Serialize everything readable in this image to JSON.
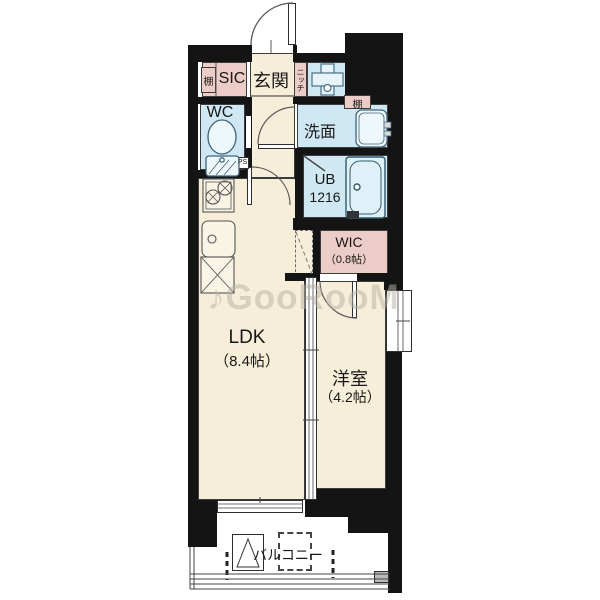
{
  "watermark": "♪GooRooM",
  "labels": {
    "shelf_entrance": "棚",
    "sic": "SIC",
    "genkan": "玄関",
    "niche": "ニッチ",
    "wc": "WC",
    "ps": "PS",
    "washroom": "洗面",
    "shelf_washroom": "棚",
    "unit_bath": "UB",
    "unit_bath_size": "1216",
    "wic": "WIC",
    "wic_area": "（0.8帖）",
    "ldk": "LDK",
    "ldk_area": "（8.4帖）",
    "western_room": "洋室",
    "western_room_area": "（4.2帖）",
    "balcony": "バルコニー"
  },
  "colors": {
    "wall": "#141414",
    "room_beige": "#f6eed8",
    "wet_area_blue": "#cfe8f4",
    "storage_pink": "#ecccc6",
    "fixture_line": "#3f637a",
    "watermark_gray": "#b8b2a6"
  },
  "icons": {
    "entrance-door-icon": "quarter-arc swing door",
    "interior-door-icon": "quarter-arc swing door",
    "folding-bath-door-icon": "diagonal line",
    "toilet-icon": "bowl and tank",
    "washbasin-icon": "rounded basin with faucet",
    "bathtub-icon": "rounded tub with drain",
    "washing-machine-pan-icon": "cross pan with drain circle",
    "stove-icon": "two burners",
    "kitchen-sink-icon": "rounded sink with drain",
    "refrigerator-space-icon": "box with X",
    "evacuation-hatch-icon": "square with triangle",
    "sliding-window-icon": "double-line window",
    "balcony-railing-icon": "parallel rails"
  }
}
